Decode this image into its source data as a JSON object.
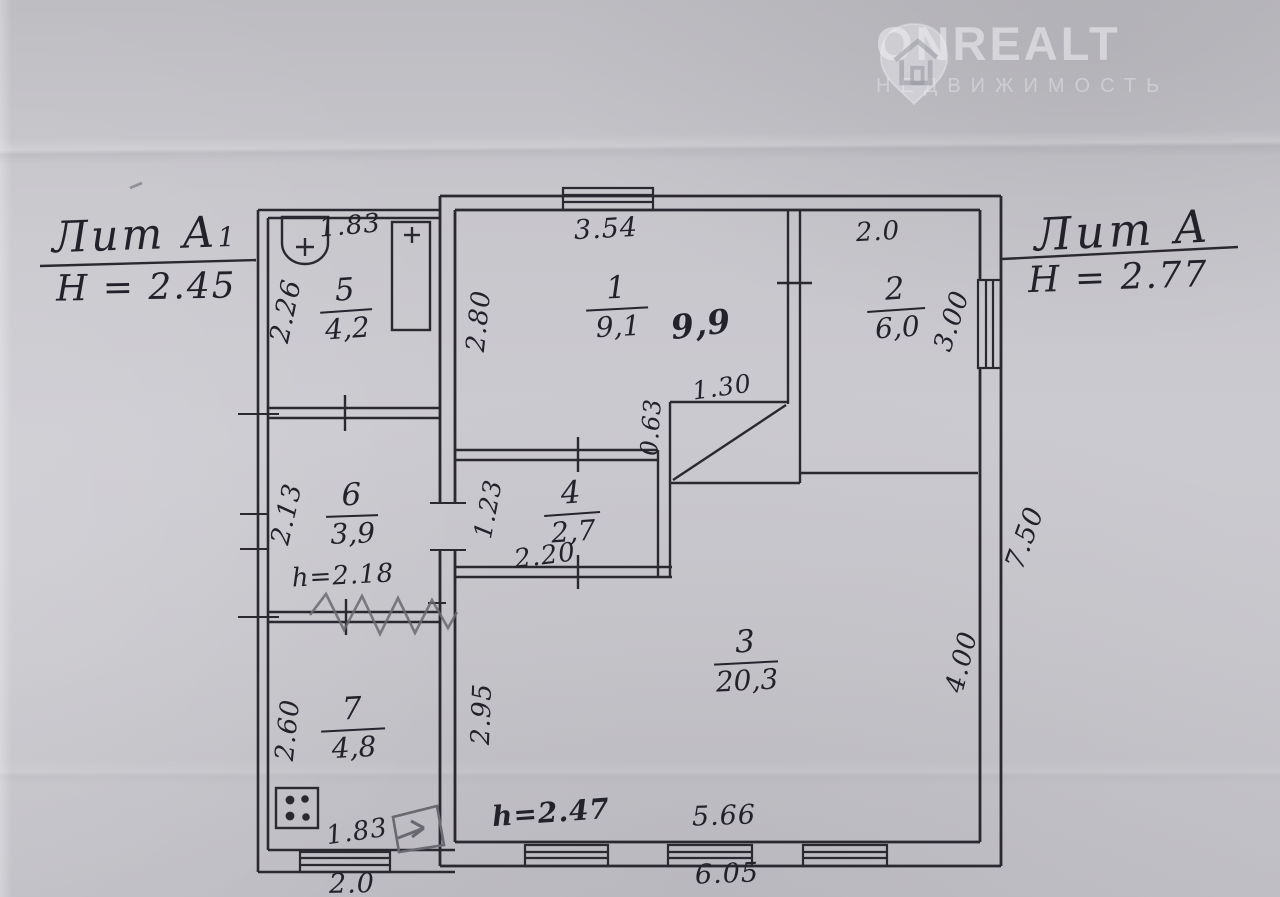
{
  "watermark": {
    "brand": "ONREALT",
    "subtitle": "НЕДВИЖИМОСТЬ",
    "icon": "house-pin-icon"
  },
  "left_block": {
    "title": "Лит А",
    "title_index": "1",
    "height_note": "H = 2.45"
  },
  "right_block": {
    "title": "Лит А",
    "height_note": "H = 2.77"
  },
  "rooms": [
    {
      "id": "room-1",
      "number": "1",
      "area": "9,1"
    },
    {
      "id": "room-2",
      "number": "2",
      "area": "6,0"
    },
    {
      "id": "room-3",
      "number": "3",
      "area": "20,3"
    },
    {
      "id": "room-4",
      "number": "4",
      "area": "2,7"
    },
    {
      "id": "room-5",
      "number": "5",
      "area": "4,2"
    },
    {
      "id": "room-6",
      "number": "6",
      "area": "3,9"
    },
    {
      "id": "room-7",
      "number": "7",
      "area": "4,8"
    }
  ],
  "annotations": [
    {
      "id": "dim-top-room5",
      "text": "1.83"
    },
    {
      "id": "dim-left-room5",
      "text": "2.26"
    },
    {
      "id": "dim-top-room1",
      "text": "3.54"
    },
    {
      "id": "dim-left-room1",
      "text": "2.80"
    },
    {
      "id": "dim-top-room2",
      "text": "2.0"
    },
    {
      "id": "dim-right-room2",
      "text": "3.00"
    },
    {
      "id": "dim-niche-width",
      "text": "1.30"
    },
    {
      "id": "dim-niche-height",
      "text": "0.63"
    },
    {
      "id": "dim-left-room6",
      "text": "2.13"
    },
    {
      "id": "dim-left-room4",
      "text": "1.23"
    },
    {
      "id": "dim-bottom-room4",
      "text": "2.20"
    },
    {
      "id": "dim-left-room3",
      "text": "2.95"
    },
    {
      "id": "dim-right-room3",
      "text": "4.00"
    },
    {
      "id": "dim-right-outer",
      "text": "7.50"
    },
    {
      "id": "dim-left-room7",
      "text": "2.60"
    },
    {
      "id": "dim-bottom-room7",
      "text": "1.83"
    },
    {
      "id": "dim-bottom-room3",
      "text": "5.66"
    },
    {
      "id": "dim-bottom-main",
      "text": "6.05"
    },
    {
      "id": "dim-bottom-annex",
      "text": "2.0"
    },
    {
      "id": "note-height-room3",
      "text": "h=2.47"
    },
    {
      "id": "note-height-room6",
      "text": "h=2.18"
    },
    {
      "id": "area-correction-room1",
      "text": "9,9"
    }
  ],
  "icons": {
    "toilet": "toilet-icon",
    "heater": "heater-column-icon",
    "stove": "stove-icon",
    "watermark_pin": "house-pin-icon",
    "pencil_arrow": "pencil-arrow-mark"
  },
  "colors": {
    "paper": "#c6c5ca",
    "ink": "#2b2930",
    "pencil": "#6a6870",
    "watermark": "rgba(240,240,244,0.55)"
  }
}
